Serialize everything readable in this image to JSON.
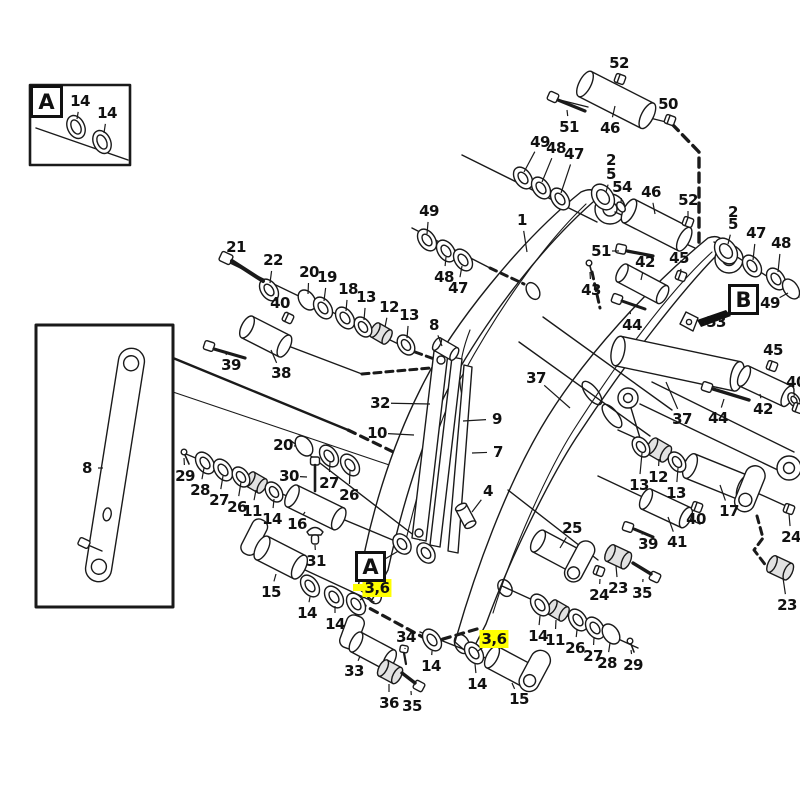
{
  "diagram_type": "exploded-parts-diagram",
  "colors": {
    "ink": "#1a1a1a",
    "background": "#ffffff",
    "highlight": "#ffff00"
  },
  "view_refs": [
    {
      "letter": "A",
      "x": 30,
      "y": 85,
      "w": 33,
      "h": 33
    },
    {
      "letter": "A",
      "x": 355,
      "y": 551,
      "w": 31,
      "h": 31
    },
    {
      "letter": "B",
      "x": 728,
      "y": 284,
      "w": 31,
      "h": 31
    }
  ],
  "highlight_bar": {
    "x": 353,
    "y": 584,
    "w": 36,
    "h": 7
  },
  "callouts": [
    {
      "t": "52",
      "x": 619,
      "y": 63,
      "lx": 620,
      "ly": 74
    },
    {
      "t": "50",
      "x": 668,
      "y": 104,
      "lx": 670,
      "ly": 114
    },
    {
      "t": "51",
      "x": 569,
      "y": 127,
      "lx": 567,
      "ly": 110
    },
    {
      "t": "46",
      "x": 610,
      "y": 128,
      "lx": 615,
      "ly": 106
    },
    {
      "t": "49",
      "x": 540,
      "y": 142,
      "lx": 524,
      "ly": 172
    },
    {
      "t": "48",
      "x": 556,
      "y": 148,
      "lx": 542,
      "ly": 182
    },
    {
      "t": "47",
      "x": 574,
      "y": 154,
      "lx": 561,
      "ly": 193
    },
    {
      "t": "2",
      "x": 611,
      "y": 160
    },
    {
      "t": "5",
      "x": 611,
      "y": 174,
      "lx": 606,
      "ly": 192
    },
    {
      "t": "54",
      "x": 622,
      "y": 187,
      "lx": 621,
      "ly": 203
    },
    {
      "t": "46",
      "x": 651,
      "y": 192,
      "lx": 655,
      "ly": 214
    },
    {
      "t": "52",
      "x": 688,
      "y": 200,
      "lx": 688,
      "ly": 217
    },
    {
      "t": "49",
      "x": 429,
      "y": 211,
      "lx": 427,
      "ly": 234
    },
    {
      "t": "1",
      "x": 522,
      "y": 220,
      "lx": 527,
      "ly": 252
    },
    {
      "t": "2",
      "x": 733,
      "y": 212
    },
    {
      "t": "5",
      "x": 733,
      "y": 224,
      "lx": 728,
      "ly": 244
    },
    {
      "t": "47",
      "x": 756,
      "y": 233,
      "lx": 753,
      "ly": 260
    },
    {
      "t": "48",
      "x": 781,
      "y": 243,
      "lx": 778,
      "ly": 272
    },
    {
      "t": "21",
      "x": 236,
      "y": 247,
      "lx": 229,
      "ly": 254
    },
    {
      "t": "51",
      "x": 601,
      "y": 251,
      "lx": 619,
      "ly": 251
    },
    {
      "t": "45",
      "x": 679,
      "y": 258,
      "lx": 681,
      "ly": 271
    },
    {
      "t": "42",
      "x": 645,
      "y": 262,
      "lx": 641,
      "ly": 280
    },
    {
      "t": "22",
      "x": 273,
      "y": 260,
      "lx": 270,
      "ly": 283
    },
    {
      "t": "20",
      "x": 309,
      "y": 272,
      "lx": 308,
      "ly": 294
    },
    {
      "t": "19",
      "x": 327,
      "y": 277,
      "lx": 324,
      "ly": 301
    },
    {
      "t": "48",
      "x": 444,
      "y": 277,
      "lx": 446,
      "ly": 257
    },
    {
      "t": "47",
      "x": 458,
      "y": 288,
      "lx": 462,
      "ly": 266
    },
    {
      "t": "18",
      "x": 348,
      "y": 289,
      "lx": 346,
      "ly": 311
    },
    {
      "t": "43",
      "x": 591,
      "y": 290,
      "lx": 590,
      "ly": 272
    },
    {
      "t": "13",
      "x": 366,
      "y": 297,
      "lx": 364,
      "ly": 320
    },
    {
      "t": "40",
      "x": 280,
      "y": 303,
      "lx": 287,
      "ly": 312
    },
    {
      "t": "49",
      "x": 770,
      "y": 303,
      "lx": 788,
      "ly": 293
    },
    {
      "t": "12",
      "x": 389,
      "y": 307,
      "lx": 385,
      "ly": 327
    },
    {
      "t": "13",
      "x": 409,
      "y": 315,
      "lx": 407,
      "ly": 338
    },
    {
      "t": "53",
      "x": 716,
      "y": 322,
      "lx": 704,
      "ly": 323
    },
    {
      "t": "44",
      "x": 632,
      "y": 325,
      "lx": 630,
      "ly": 311
    },
    {
      "t": "8",
      "x": 434,
      "y": 325,
      "lx": 442,
      "ly": 346
    },
    {
      "t": "45",
      "x": 773,
      "y": 350,
      "lx": 772,
      "ly": 361
    },
    {
      "t": "39",
      "x": 231,
      "y": 365,
      "lx": 226,
      "ly": 354
    },
    {
      "t": "38",
      "x": 281,
      "y": 373,
      "lx": 271,
      "ly": 350
    },
    {
      "t": "37",
      "x": 536,
      "y": 378,
      "lx": 570,
      "ly": 408
    },
    {
      "t": "40",
      "x": 796,
      "y": 382,
      "lx": 794,
      "ly": 396
    },
    {
      "t": "32",
      "x": 380,
      "y": 403,
      "lx": 430,
      "ly": 404
    },
    {
      "t": "42",
      "x": 763,
      "y": 409,
      "lx": 760,
      "ly": 394
    },
    {
      "t": "9",
      "x": 497,
      "y": 419,
      "lx": 463,
      "ly": 421
    },
    {
      "t": "37",
      "x": 682,
      "y": 419,
      "lx": 666,
      "ly": 382
    },
    {
      "t": "44",
      "x": 718,
      "y": 418,
      "lx": 724,
      "ly": 399
    },
    {
      "t": "10",
      "x": 377,
      "y": 433,
      "lx": 414,
      "ly": 435
    },
    {
      "t": "20",
      "x": 283,
      "y": 445,
      "lx": 296,
      "ly": 446
    },
    {
      "t": "7",
      "x": 498,
      "y": 452,
      "lx": 472,
      "ly": 453
    },
    {
      "t": "8",
      "x": 87,
      "y": 468,
      "lx": 103,
      "ly": 468
    },
    {
      "t": "29",
      "x": 185,
      "y": 476,
      "lx": 184,
      "ly": 458
    },
    {
      "t": "30",
      "x": 289,
      "y": 476,
      "lx": 307,
      "ly": 477
    },
    {
      "t": "12",
      "x": 658,
      "y": 477,
      "lx": 659,
      "ly": 459
    },
    {
      "t": "27",
      "x": 329,
      "y": 483,
      "lx": 330,
      "ly": 462
    },
    {
      "t": "13",
      "x": 639,
      "y": 485,
      "lx": 642,
      "ly": 453
    },
    {
      "t": "28",
      "x": 200,
      "y": 490,
      "lx": 204,
      "ly": 468
    },
    {
      "t": "4",
      "x": 488,
      "y": 491,
      "lx": 472,
      "ly": 512
    },
    {
      "t": "13",
      "x": 676,
      "y": 493,
      "lx": 678,
      "ly": 468
    },
    {
      "t": "26",
      "x": 349,
      "y": 495,
      "lx": 350,
      "ly": 470
    },
    {
      "t": "27",
      "x": 219,
      "y": 500,
      "lx": 223,
      "ly": 476
    },
    {
      "t": "26",
      "x": 237,
      "y": 507,
      "lx": 241,
      "ly": 482
    },
    {
      "t": "11",
      "x": 252,
      "y": 511,
      "lx": 256,
      "ly": 490
    },
    {
      "t": "17",
      "x": 729,
      "y": 511,
      "lx": 720,
      "ly": 485
    },
    {
      "t": "40",
      "x": 696,
      "y": 519,
      "lx": 697,
      "ly": 511
    },
    {
      "t": "14",
      "x": 272,
      "y": 519,
      "lx": 274,
      "ly": 499
    },
    {
      "t": "16",
      "x": 297,
      "y": 524,
      "lx": 305,
      "ly": 512
    },
    {
      "t": "25",
      "x": 572,
      "y": 528,
      "lx": 560,
      "ly": 548
    },
    {
      "t": "24",
      "x": 791,
      "y": 537,
      "lx": 789,
      "ly": 514
    },
    {
      "t": "41",
      "x": 677,
      "y": 542,
      "lx": 668,
      "ly": 517
    },
    {
      "t": "39",
      "x": 648,
      "y": 544,
      "lx": 642,
      "ly": 534
    },
    {
      "t": "31",
      "x": 316,
      "y": 561,
      "lx": 315,
      "ly": 545
    },
    {
      "t": "3,6",
      "x": 377,
      "y": 588,
      "hl": true,
      "lx": 360,
      "ly": 600
    },
    {
      "t": "23",
      "x": 618,
      "y": 588,
      "lx": 616,
      "ly": 566
    },
    {
      "t": "15",
      "x": 271,
      "y": 592,
      "lx": 276,
      "ly": 574
    },
    {
      "t": "35",
      "x": 642,
      "y": 593,
      "lx": 643,
      "ly": 579
    },
    {
      "t": "24",
      "x": 599,
      "y": 595,
      "lx": 600,
      "ly": 579
    },
    {
      "t": "23",
      "x": 787,
      "y": 605,
      "lx": 783,
      "ly": 578
    },
    {
      "t": "14",
      "x": 307,
      "y": 613,
      "lx": 310,
      "ly": 597
    },
    {
      "t": "14",
      "x": 335,
      "y": 624,
      "lx": 335,
      "ly": 606
    },
    {
      "t": "14",
      "x": 538,
      "y": 636,
      "lx": 540,
      "ly": 616
    },
    {
      "t": "34",
      "x": 406,
      "y": 637,
      "lx": 405,
      "ly": 649
    },
    {
      "t": "3,6",
      "x": 494,
      "y": 639,
      "hl": true,
      "lx": 478,
      "ly": 651
    },
    {
      "t": "11",
      "x": 555,
      "y": 640,
      "lx": 556,
      "ly": 620
    },
    {
      "t": "26",
      "x": 575,
      "y": 648,
      "lx": 577,
      "ly": 630
    },
    {
      "t": "27",
      "x": 593,
      "y": 656,
      "lx": 594,
      "ly": 637
    },
    {
      "t": "28",
      "x": 607,
      "y": 663,
      "lx": 610,
      "ly": 643
    },
    {
      "t": "29",
      "x": 633,
      "y": 665,
      "lx": 631,
      "ly": 650
    },
    {
      "t": "14",
      "x": 431,
      "y": 666,
      "lx": 432,
      "ly": 651
    },
    {
      "t": "33",
      "x": 354,
      "y": 671,
      "lx": 360,
      "ly": 656
    },
    {
      "t": "14",
      "x": 477,
      "y": 684,
      "lx": 475,
      "ly": 664
    },
    {
      "t": "15",
      "x": 519,
      "y": 699,
      "lx": 512,
      "ly": 683
    },
    {
      "t": "36",
      "x": 389,
      "y": 703,
      "lx": 389,
      "ly": 684
    },
    {
      "t": "35",
      "x": 412,
      "y": 706,
      "lx": 411,
      "ly": 691
    },
    {
      "t": "14",
      "x": 80,
      "y": 101,
      "lx": 77,
      "ly": 119
    },
    {
      "t": "14",
      "x": 107,
      "y": 113,
      "lx": 104,
      "ly": 133
    }
  ]
}
